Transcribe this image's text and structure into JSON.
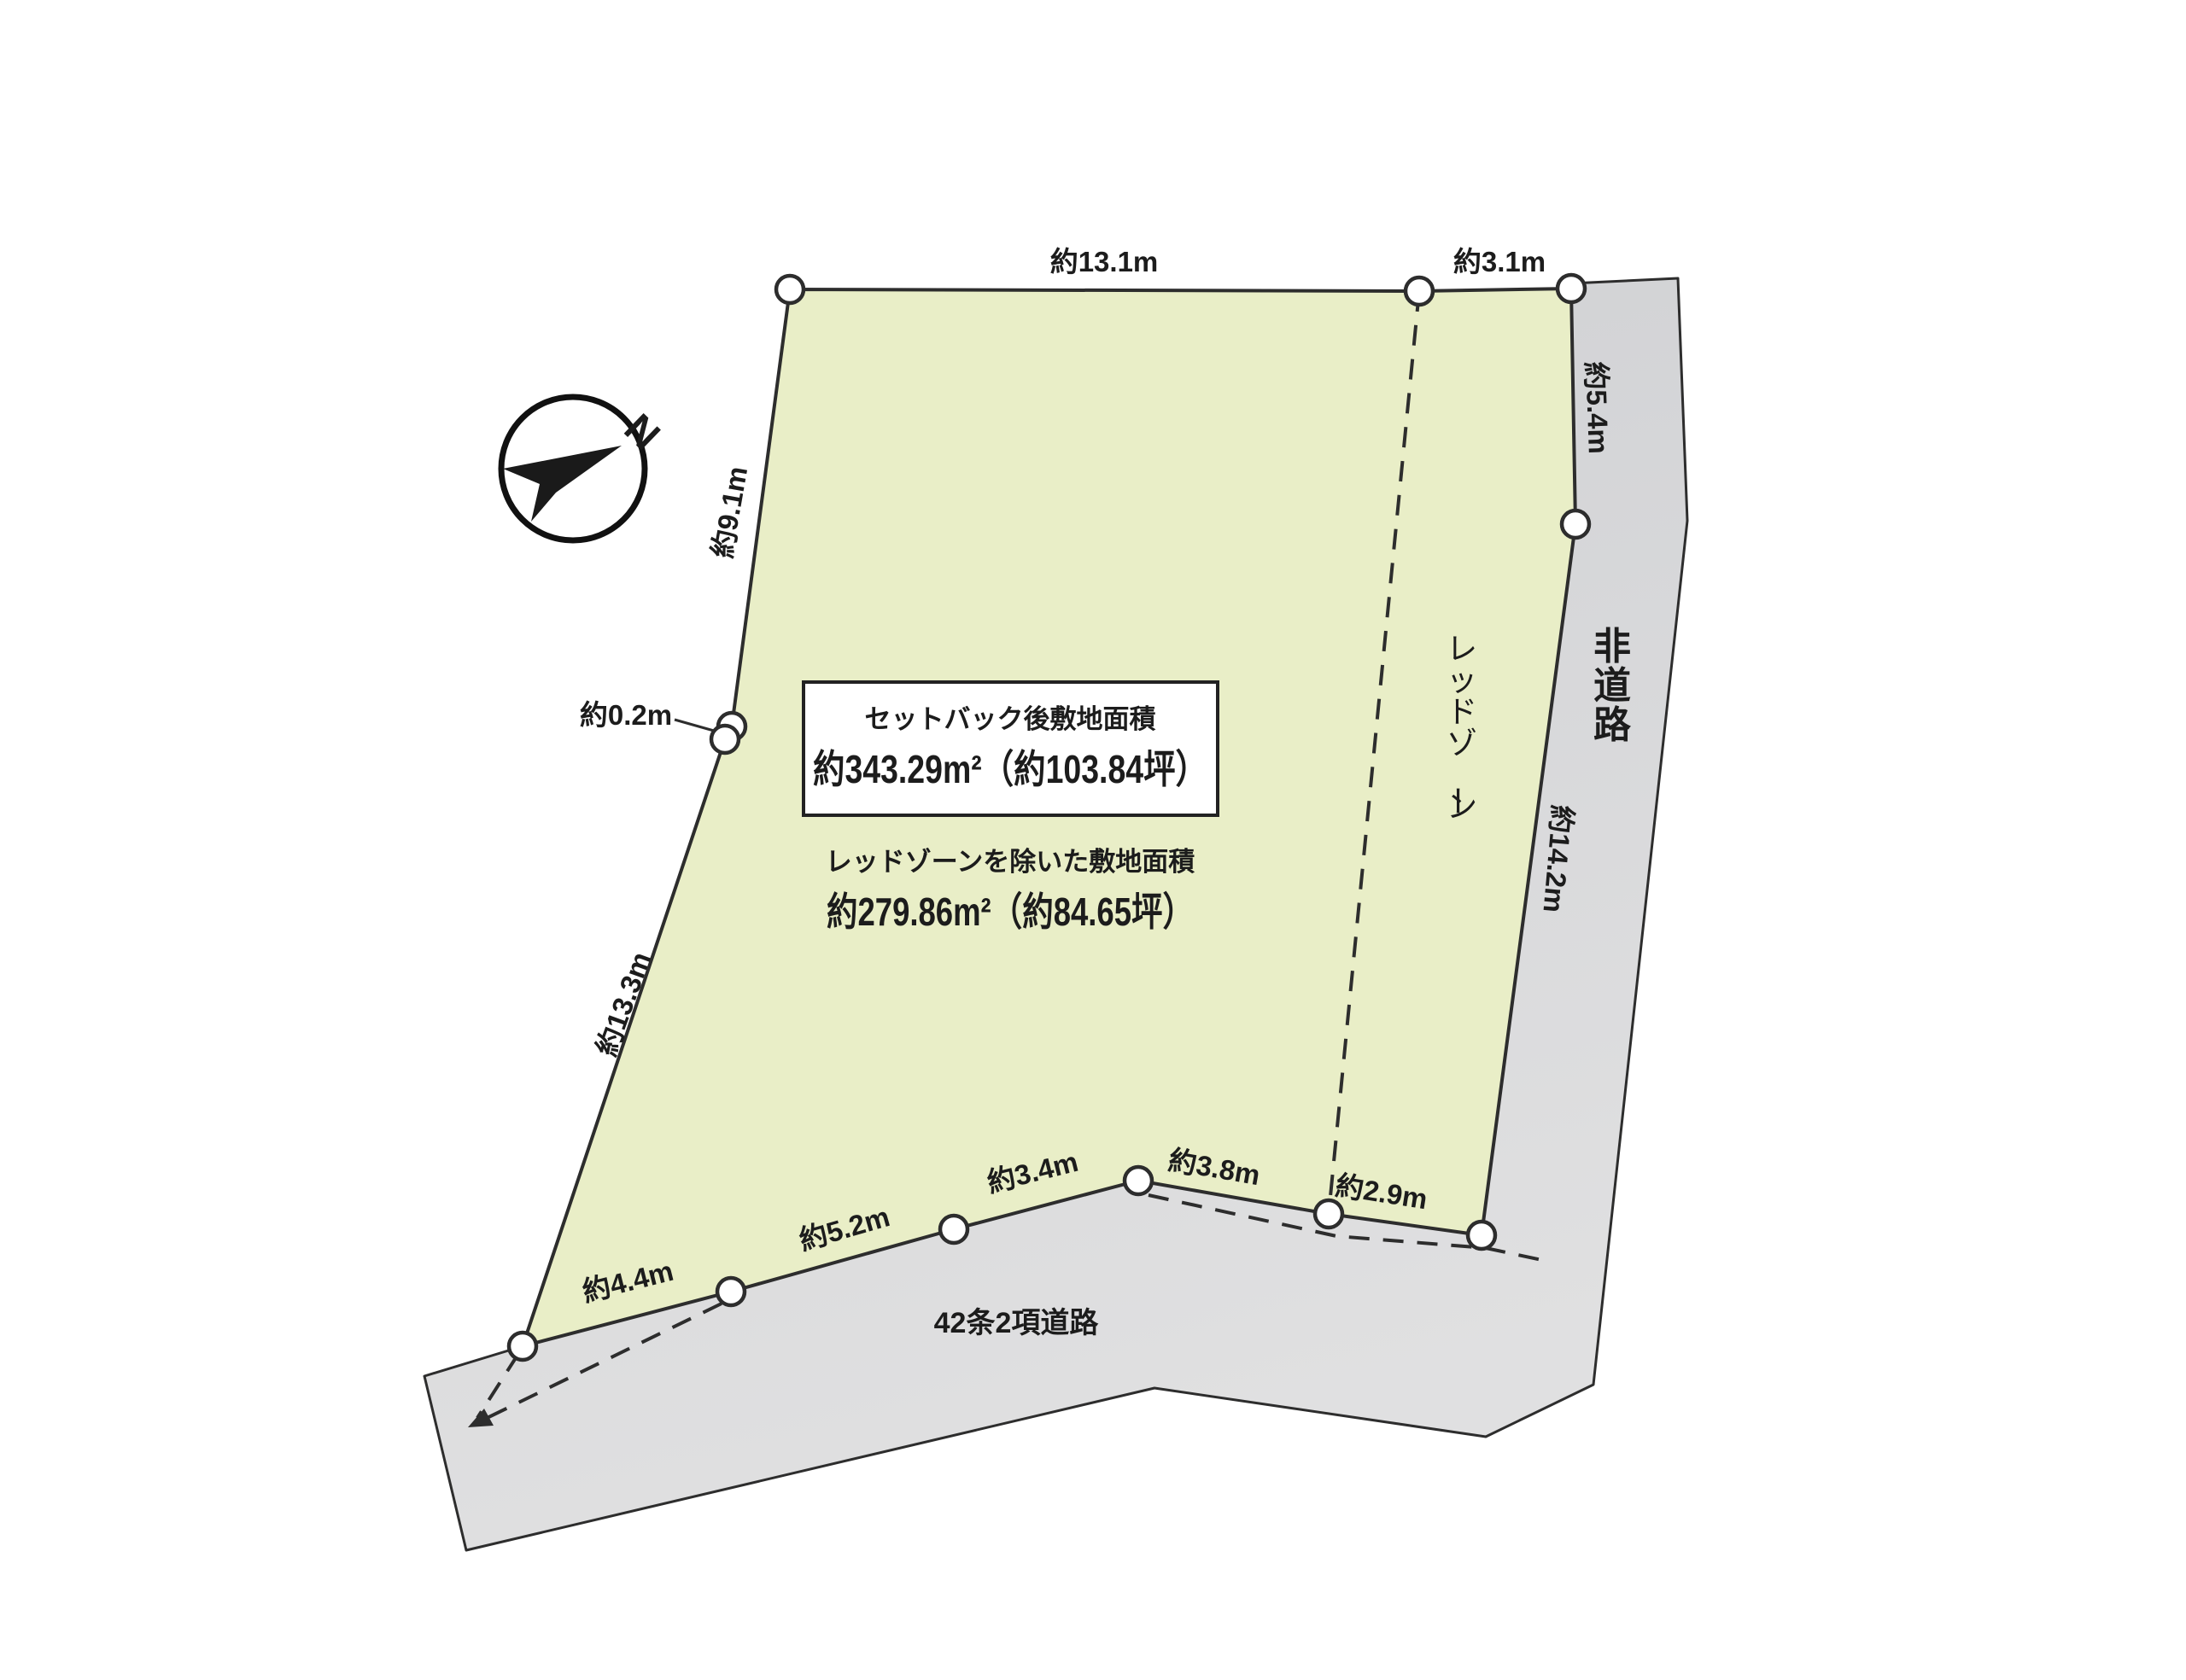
{
  "compass": {
    "north_label": "N"
  },
  "areas": {
    "setback_title": "セットバック後敷地面積",
    "setback_value": "約343.29m²（約103.84坪）",
    "redzone_title": "レッドゾーンを除いた敷地面積",
    "redzone_value": "約279.86m²（約84.65坪）"
  },
  "measurements": {
    "top_main": "約13.1m",
    "top_right": "約3.1m",
    "right_upper": "約5.4m",
    "right_lower": "約14.2m",
    "left_upper": "約9.1m",
    "left_jog": "約0.2m",
    "left_lower": "約13.3m",
    "bottom_1": "約4.4m",
    "bottom_2": "約5.2m",
    "bottom_3": "約3.4m",
    "bottom_4": "約3.8m",
    "bottom_5": "約2.9m"
  },
  "labels": {
    "red_zone": "レッドゾーン",
    "road_right": "非道路",
    "road_bottom": "42条2項道路"
  },
  "colors": {
    "parcel_fill": "#e9eec7",
    "road_fill": "#d5d6d8",
    "outline": "#2d2d2d",
    "text": "#1c1c1c",
    "background": "#ffffff"
  }
}
